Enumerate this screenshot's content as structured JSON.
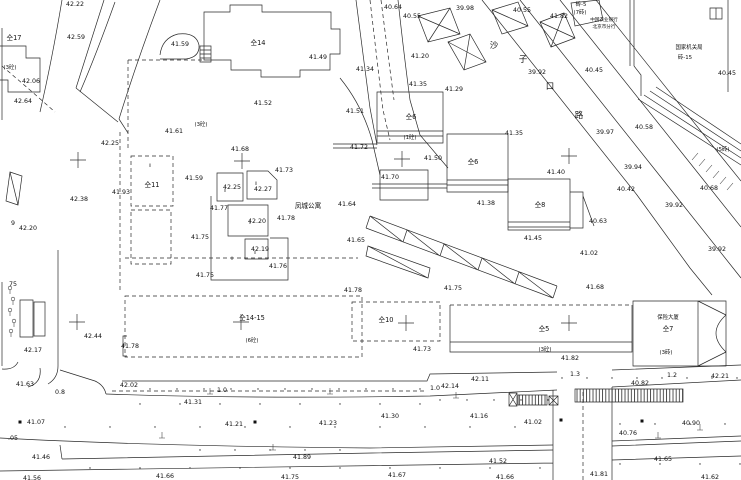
{
  "map": {
    "background": "#ffffff",
    "ink": "#2a2a2a",
    "spot_elevations": [
      {
        "x": 75,
        "y": 4,
        "v": "42.22"
      },
      {
        "x": 76,
        "y": 37,
        "v": "42.59"
      },
      {
        "x": 180,
        "y": 44,
        "v": "41.59"
      },
      {
        "x": 31,
        "y": 81,
        "v": "42.06"
      },
      {
        "x": 23,
        "y": 101,
        "v": "42.64"
      },
      {
        "x": 174,
        "y": 131,
        "v": "41.61"
      },
      {
        "x": 110,
        "y": 143,
        "v": "42.25"
      },
      {
        "x": 240,
        "y": 149,
        "v": "41.68"
      },
      {
        "x": 121,
        "y": 192,
        "v": "41.93"
      },
      {
        "x": 79,
        "y": 199,
        "v": "42.38"
      },
      {
        "x": 28,
        "y": 228,
        "v": "42.20"
      },
      {
        "x": 194,
        "y": 178,
        "v": "41.59"
      },
      {
        "x": 232,
        "y": 187,
        "v": "42.25"
      },
      {
        "x": 263,
        "y": 189,
        "v": "42.27"
      },
      {
        "x": 284,
        "y": 170,
        "v": "41.73"
      },
      {
        "x": 219,
        "y": 208,
        "v": "41.77"
      },
      {
        "x": 257,
        "y": 221,
        "v": "42.20"
      },
      {
        "x": 286,
        "y": 218,
        "v": "41.78"
      },
      {
        "x": 200,
        "y": 237,
        "v": "41.75"
      },
      {
        "x": 260,
        "y": 249,
        "v": "42.19"
      },
      {
        "x": 278,
        "y": 266,
        "v": "41.76"
      },
      {
        "x": 205,
        "y": 275,
        "v": "41.75"
      },
      {
        "x": 347,
        "y": 204,
        "v": "41.64"
      },
      {
        "x": 318,
        "y": 57,
        "v": "41.49"
      },
      {
        "x": 263,
        "y": 103,
        "v": "41.52"
      },
      {
        "x": 355,
        "y": 111,
        "v": "41.51"
      },
      {
        "x": 359,
        "y": 147,
        "v": "41.72"
      },
      {
        "x": 365,
        "y": 69,
        "v": "41.34"
      },
      {
        "x": 393,
        "y": 7,
        "v": "40.64"
      },
      {
        "x": 412,
        "y": 16,
        "v": "40.55"
      },
      {
        "x": 465,
        "y": 8,
        "v": "39.98"
      },
      {
        "x": 420,
        "y": 56,
        "v": "41.20"
      },
      {
        "x": 418,
        "y": 84,
        "v": "41.35"
      },
      {
        "x": 454,
        "y": 89,
        "v": "41.29"
      },
      {
        "x": 522,
        "y": 10,
        "v": "40.55"
      },
      {
        "x": 559,
        "y": 16,
        "v": "41.82"
      },
      {
        "x": 537,
        "y": 72,
        "v": "39.92"
      },
      {
        "x": 594,
        "y": 70,
        "v": "40.45"
      },
      {
        "x": 727,
        "y": 73,
        "v": "40.45"
      },
      {
        "x": 605,
        "y": 132,
        "v": "39.97"
      },
      {
        "x": 644,
        "y": 127,
        "v": "40.58"
      },
      {
        "x": 514,
        "y": 133,
        "v": "41.35"
      },
      {
        "x": 433,
        "y": 158,
        "v": "41.50"
      },
      {
        "x": 390,
        "y": 177,
        "v": "41.70"
      },
      {
        "x": 556,
        "y": 172,
        "v": "41.40"
      },
      {
        "x": 486,
        "y": 203,
        "v": "41.38"
      },
      {
        "x": 533,
        "y": 238,
        "v": "41.45"
      },
      {
        "x": 633,
        "y": 167,
        "v": "39.94"
      },
      {
        "x": 626,
        "y": 189,
        "v": "40.42"
      },
      {
        "x": 709,
        "y": 188,
        "v": "40.68"
      },
      {
        "x": 674,
        "y": 205,
        "v": "39.92"
      },
      {
        "x": 598,
        "y": 221,
        "v": "40.63"
      },
      {
        "x": 717,
        "y": 249,
        "v": "39.92"
      },
      {
        "x": 589,
        "y": 253,
        "v": "41.02"
      },
      {
        "x": 595,
        "y": 287,
        "v": "41.68"
      },
      {
        "x": 453,
        "y": 288,
        "v": "41.75"
      },
      {
        "x": 353,
        "y": 290,
        "v": "41.78"
      },
      {
        "x": 356,
        "y": 240,
        "v": "41.65"
      },
      {
        "x": 422,
        "y": 349,
        "v": "41.73"
      },
      {
        "x": 570,
        "y": 358,
        "v": "41.82"
      },
      {
        "x": 480,
        "y": 379,
        "v": "42.11"
      },
      {
        "x": 450,
        "y": 386,
        "v": "42.14"
      },
      {
        "x": 640,
        "y": 383,
        "v": "40.82"
      },
      {
        "x": 720,
        "y": 376,
        "v": "42.21"
      },
      {
        "x": 93,
        "y": 336,
        "v": "42.44"
      },
      {
        "x": 33,
        "y": 350,
        "v": "42.17"
      },
      {
        "x": 130,
        "y": 346,
        "v": "41.78"
      },
      {
        "x": 25,
        "y": 384,
        "v": "41.63"
      },
      {
        "x": 129,
        "y": 385,
        "v": "42.02"
      },
      {
        "x": 193,
        "y": 402,
        "v": "41.31"
      },
      {
        "x": 390,
        "y": 416,
        "v": "41.30"
      },
      {
        "x": 479,
        "y": 416,
        "v": "41.16"
      },
      {
        "x": 36,
        "y": 422,
        "v": "41.07"
      },
      {
        "x": 234,
        "y": 424,
        "v": "41.21"
      },
      {
        "x": 328,
        "y": 423,
        "v": "41.23"
      },
      {
        "x": 533,
        "y": 422,
        "v": "41.02"
      },
      {
        "x": 628,
        "y": 433,
        "v": "40.76"
      },
      {
        "x": 691,
        "y": 423,
        "v": "40.90"
      },
      {
        "x": 41,
        "y": 457,
        "v": "41.46"
      },
      {
        "x": 302,
        "y": 457,
        "v": "41.89"
      },
      {
        "x": 498,
        "y": 461,
        "v": "41.52"
      },
      {
        "x": 663,
        "y": 459,
        "v": "41.65"
      },
      {
        "x": 32,
        "y": 478,
        "v": "41.56"
      },
      {
        "x": 165,
        "y": 476,
        "v": "41.66"
      },
      {
        "x": 290,
        "y": 477,
        "v": "41.75"
      },
      {
        "x": 397,
        "y": 475,
        "v": "41.67"
      },
      {
        "x": 505,
        "y": 477,
        "v": "41.66"
      },
      {
        "x": 599,
        "y": 474,
        "v": "41.81"
      },
      {
        "x": 710,
        "y": 477,
        "v": "41.62"
      }
    ],
    "building_labels": [
      {
        "x": 14,
        "y": 38,
        "t": "仝17"
      },
      {
        "x": 258,
        "y": 43,
        "t": "仝14"
      },
      {
        "x": 152,
        "y": 185,
        "t": "仝11"
      },
      {
        "x": 411,
        "y": 117,
        "t": "仝6"
      },
      {
        "x": 473,
        "y": 162,
        "t": "仝6"
      },
      {
        "x": 540,
        "y": 205,
        "t": "仝8"
      },
      {
        "x": 386,
        "y": 320,
        "t": "仝10"
      },
      {
        "x": 544,
        "y": 329,
        "t": "仝5"
      },
      {
        "x": 668,
        "y": 329,
        "t": "仝7"
      },
      {
        "x": 252,
        "y": 318,
        "t": "仝14-15"
      }
    ],
    "construction_notes": [
      {
        "x": 10,
        "y": 67,
        "t": "(3砼)"
      },
      {
        "x": 201,
        "y": 124,
        "t": "(3砼)"
      },
      {
        "x": 410,
        "y": 137,
        "t": "(1砼)"
      },
      {
        "x": 252,
        "y": 340,
        "t": "(6砼)"
      },
      {
        "x": 545,
        "y": 349,
        "t": "(3砼)"
      },
      {
        "x": 666,
        "y": 352,
        "t": "(3砖)"
      },
      {
        "x": 581,
        "y": 4,
        "t": "砖-5"
      },
      {
        "x": 580,
        "y": 12,
        "t": "(7砖)"
      },
      {
        "x": 723,
        "y": 149,
        "t": "(5砖)"
      }
    ],
    "cjk_texts": [
      {
        "x": 308,
        "y": 206,
        "t": "凤城公寓"
      },
      {
        "x": 604,
        "y": 19,
        "t": "中国农业银行",
        "s": "xs"
      },
      {
        "x": 604,
        "y": 26,
        "t": "北京市分行",
        "s": "xs"
      },
      {
        "x": 689,
        "y": 47,
        "t": "国家机关局",
        "s": "sm"
      },
      {
        "x": 685,
        "y": 57,
        "t": "砖-15",
        "s": "sm"
      },
      {
        "x": 668,
        "y": 317,
        "t": "保险大厦",
        "s": "sm"
      }
    ],
    "street_chars": [
      {
        "x": 494,
        "y": 46,
        "t": "沙"
      },
      {
        "x": 523,
        "y": 60,
        "t": "子"
      },
      {
        "x": 550,
        "y": 87,
        "t": "口"
      },
      {
        "x": 579,
        "y": 116,
        "t": "路"
      }
    ],
    "width_labels": [
      {
        "x": 60,
        "y": 392,
        "t": "0.8"
      },
      {
        "x": 222,
        "y": 390,
        "t": "1.0"
      },
      {
        "x": 435,
        "y": 388,
        "t": "1.0"
      },
      {
        "x": 575,
        "y": 374,
        "t": "1.3"
      },
      {
        "x": 672,
        "y": 375,
        "t": "1.2"
      }
    ],
    "misc_labels": [
      {
        "x": 13,
        "y": 223,
        "t": "9"
      },
      {
        "x": 13,
        "y": 284,
        "t": "75"
      },
      {
        "x": 13,
        "y": 438,
        "t": ".05"
      }
    ],
    "building_marks": [
      {
        "x": 225,
        "y": 190,
        "t": "ll"
      },
      {
        "x": 256,
        "y": 183,
        "t": "ll"
      },
      {
        "x": 250,
        "y": 222,
        "t": "ll"
      },
      {
        "x": 255,
        "y": 252,
        "t": "ll"
      },
      {
        "x": 232,
        "y": 258,
        "t": "ll"
      },
      {
        "x": 150,
        "y": 165,
        "t": "ll"
      }
    ],
    "crosses": [
      {
        "x": 78,
        "y": 160
      },
      {
        "x": 242,
        "y": 161
      },
      {
        "x": 402,
        "y": 159
      },
      {
        "x": 569,
        "y": 156
      },
      {
        "x": 77,
        "y": 322
      },
      {
        "x": 241,
        "y": 322
      },
      {
        "x": 406,
        "y": 323
      },
      {
        "x": 569,
        "y": 323
      }
    ]
  }
}
